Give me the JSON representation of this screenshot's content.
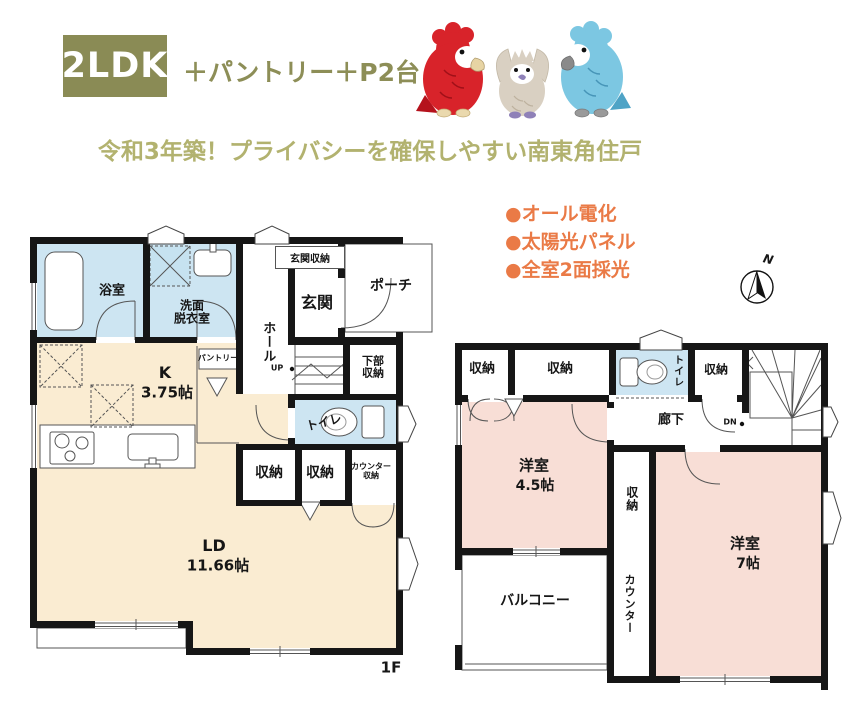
{
  "colors": {
    "olive": "#8a8b55",
    "olive_light": "#b2b26f",
    "orange": "#ea7a46",
    "room_cream": "#faecd2",
    "room_blue": "#cde5f2",
    "room_pink": "#f8ded6",
    "wall": "#161616"
  },
  "header": {
    "badge": "2LDK",
    "subtitle": "＋パントリー＋P2台",
    "title": "令和3年築！プライバシーを確保しやすい南東角住戸",
    "features": {
      "f1": "●オール電化",
      "f2": "●太陽光パネル",
      "f3": "●全室2面採光"
    },
    "compass_label": "N",
    "bird_icons": [
      "red-parrot-icon",
      "grey-cockatiel-icon",
      "blue-parrot-icon"
    ]
  },
  "plan1": {
    "floor_label": "1F",
    "rooms": {
      "bath": "浴室",
      "washroom_l1": "洗面",
      "washroom_l2": "脱衣室",
      "entrance_storage": "玄関収納",
      "entrance": "玄関",
      "porch": "ポーチ",
      "hall": "ホール",
      "pantry": "パントリー",
      "kitchen_label": "K",
      "kitchen_size": "3.75帖",
      "toilet": "トイレ",
      "under_stairs_l1": "下部",
      "under_stairs_l2": "収納",
      "storage_1": "収納",
      "storage_2": "収納",
      "counter_storage_l1": "カウンター",
      "counter_storage_l2": "収納",
      "living_label": "LD",
      "living_size": "11.66帖",
      "stairs_up": "UP"
    }
  },
  "plan2": {
    "rooms": {
      "storage_a": "収納",
      "storage_b": "収納",
      "toilet": "トイレ",
      "storage_c": "収納",
      "hallway": "廊下",
      "stairs_down": "DN",
      "western_room_45_label": "洋室",
      "western_room_45_size": "4.5帖",
      "storage_center": "収納",
      "western_room_7_label": "洋室",
      "western_room_7_size": "7帖",
      "counter": "カウンター",
      "balcony": "バルコニー"
    }
  }
}
